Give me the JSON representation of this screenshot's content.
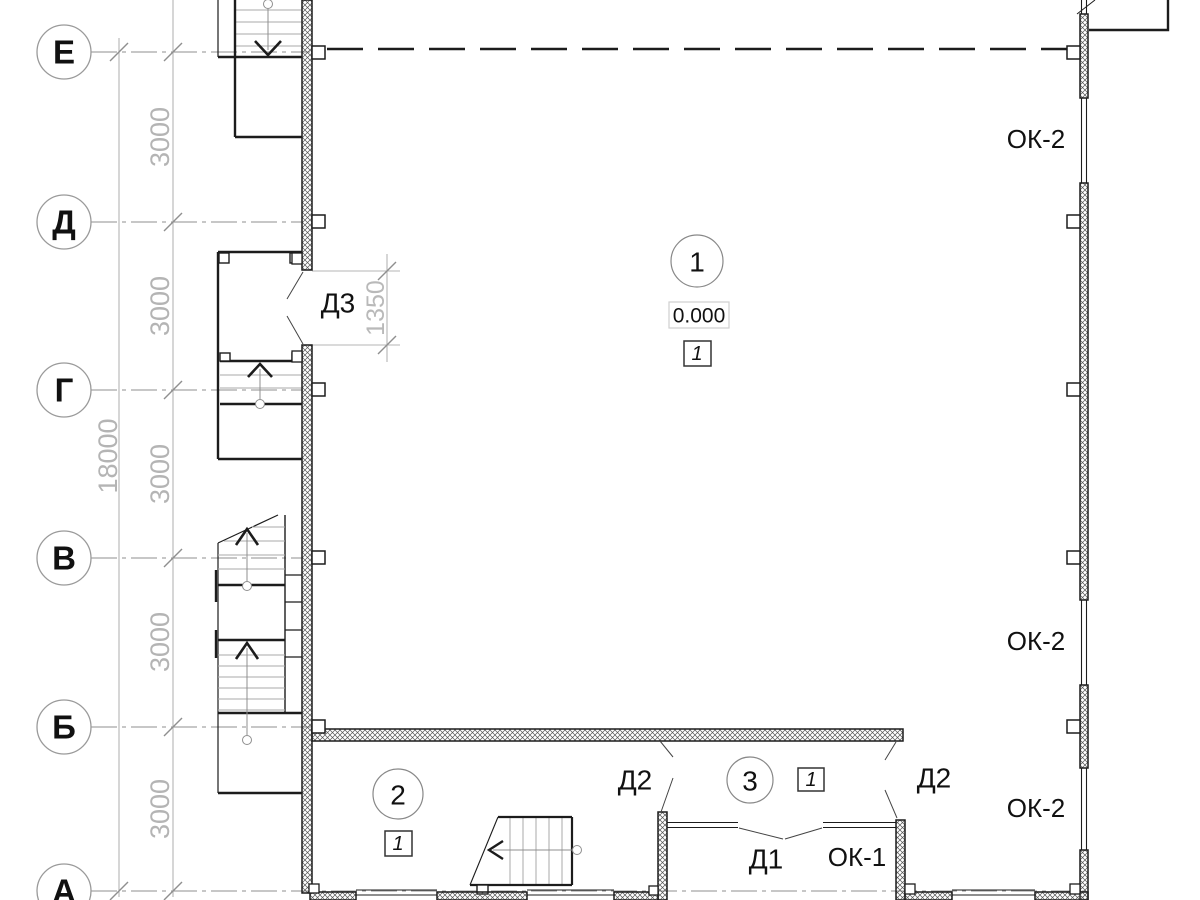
{
  "plan": {
    "title": "first floor plan (fragment)",
    "axis_labels": {
      "e": "Е",
      "d": "Д",
      "g": "Г",
      "v": "В",
      "b": "Б",
      "a": "А"
    },
    "dimensions": {
      "seg": "3000",
      "total": "18000",
      "door": "1350"
    },
    "door_marks": {
      "d3": "Д3",
      "d2": "Д2",
      "d1": "Д1"
    },
    "window_marks": {
      "ok1": "ОК-1",
      "ok2": "ОК-2"
    },
    "room_numbers": {
      "r1": "1",
      "r2": "2",
      "r3": "3"
    },
    "elevation_mark": "0.000",
    "floor_type_mark": "1",
    "colors": {
      "line": "#1c1c1c",
      "axis_gray": "#8f8f8f",
      "dim_gray": "#b4b4b4",
      "tread_gray": "#a8a8a8",
      "hatch": "#555555"
    }
  }
}
